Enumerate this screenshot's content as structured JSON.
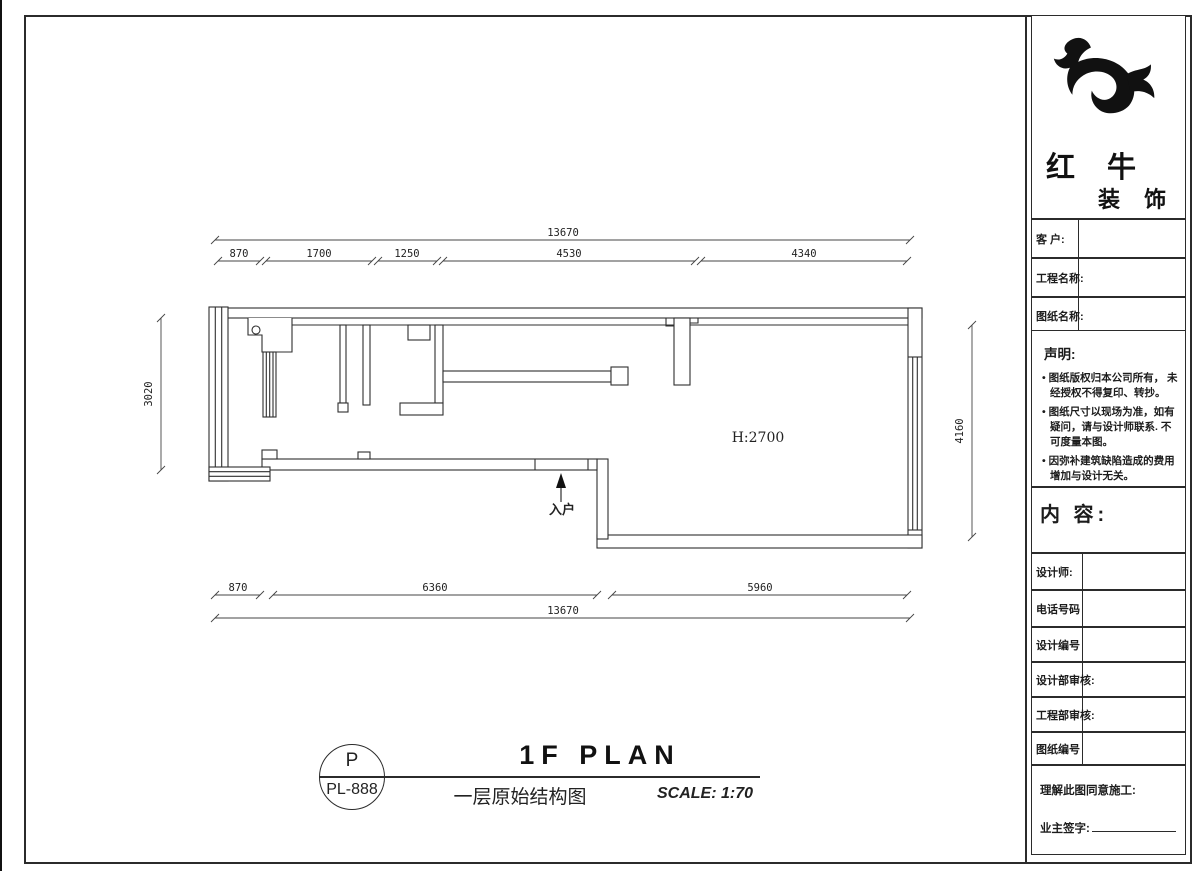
{
  "brand": {
    "title": "红 牛",
    "subtitle": "装 饰"
  },
  "panel": {
    "info_rows": [
      {
        "label": "客  户:"
      },
      {
        "label": "工程名称:"
      },
      {
        "label": "图纸名称:"
      }
    ],
    "statement": {
      "title": "声明:",
      "items": [
        "图纸版权归本公司所有， 未经授权不得复印、转抄。",
        "图纸尺寸以现场为准，如有 疑问，请与设计师联系. 不可度量本图。",
        "因弥补建筑缺陷造成的费用 增加与设计无关。"
      ]
    },
    "content_label": "内 容:",
    "detail_rows": [
      {
        "label": "设计师:"
      },
      {
        "label": "电话号码"
      },
      {
        "label": "设计编号"
      },
      {
        "label": "设计部审核:"
      },
      {
        "label": "工程部审核:"
      },
      {
        "label": "图纸编号"
      }
    ],
    "approval": {
      "consent": "理解此图同意施工:",
      "signature": "业主签字:"
    }
  },
  "plan": {
    "room_height": "H:2700",
    "entrance": "入户",
    "dims": {
      "top_total": "13670",
      "top_segments": [
        "870",
        "1700",
        "1250",
        "4530",
        "4340"
      ],
      "bottom_segments": [
        "870",
        "6360",
        "5960"
      ],
      "bottom_total": "13670",
      "left": "3020",
      "right": "4160"
    }
  },
  "footer": {
    "bubble_letter": "P",
    "bubble_code": "PL-888",
    "title": "1F PLAN",
    "subtitle": "一层原始结构图",
    "scale": "SCALE: 1:70"
  },
  "colors": {
    "line": "#2b2b2b",
    "ink": "#111111",
    "paper": "#ffffff"
  }
}
